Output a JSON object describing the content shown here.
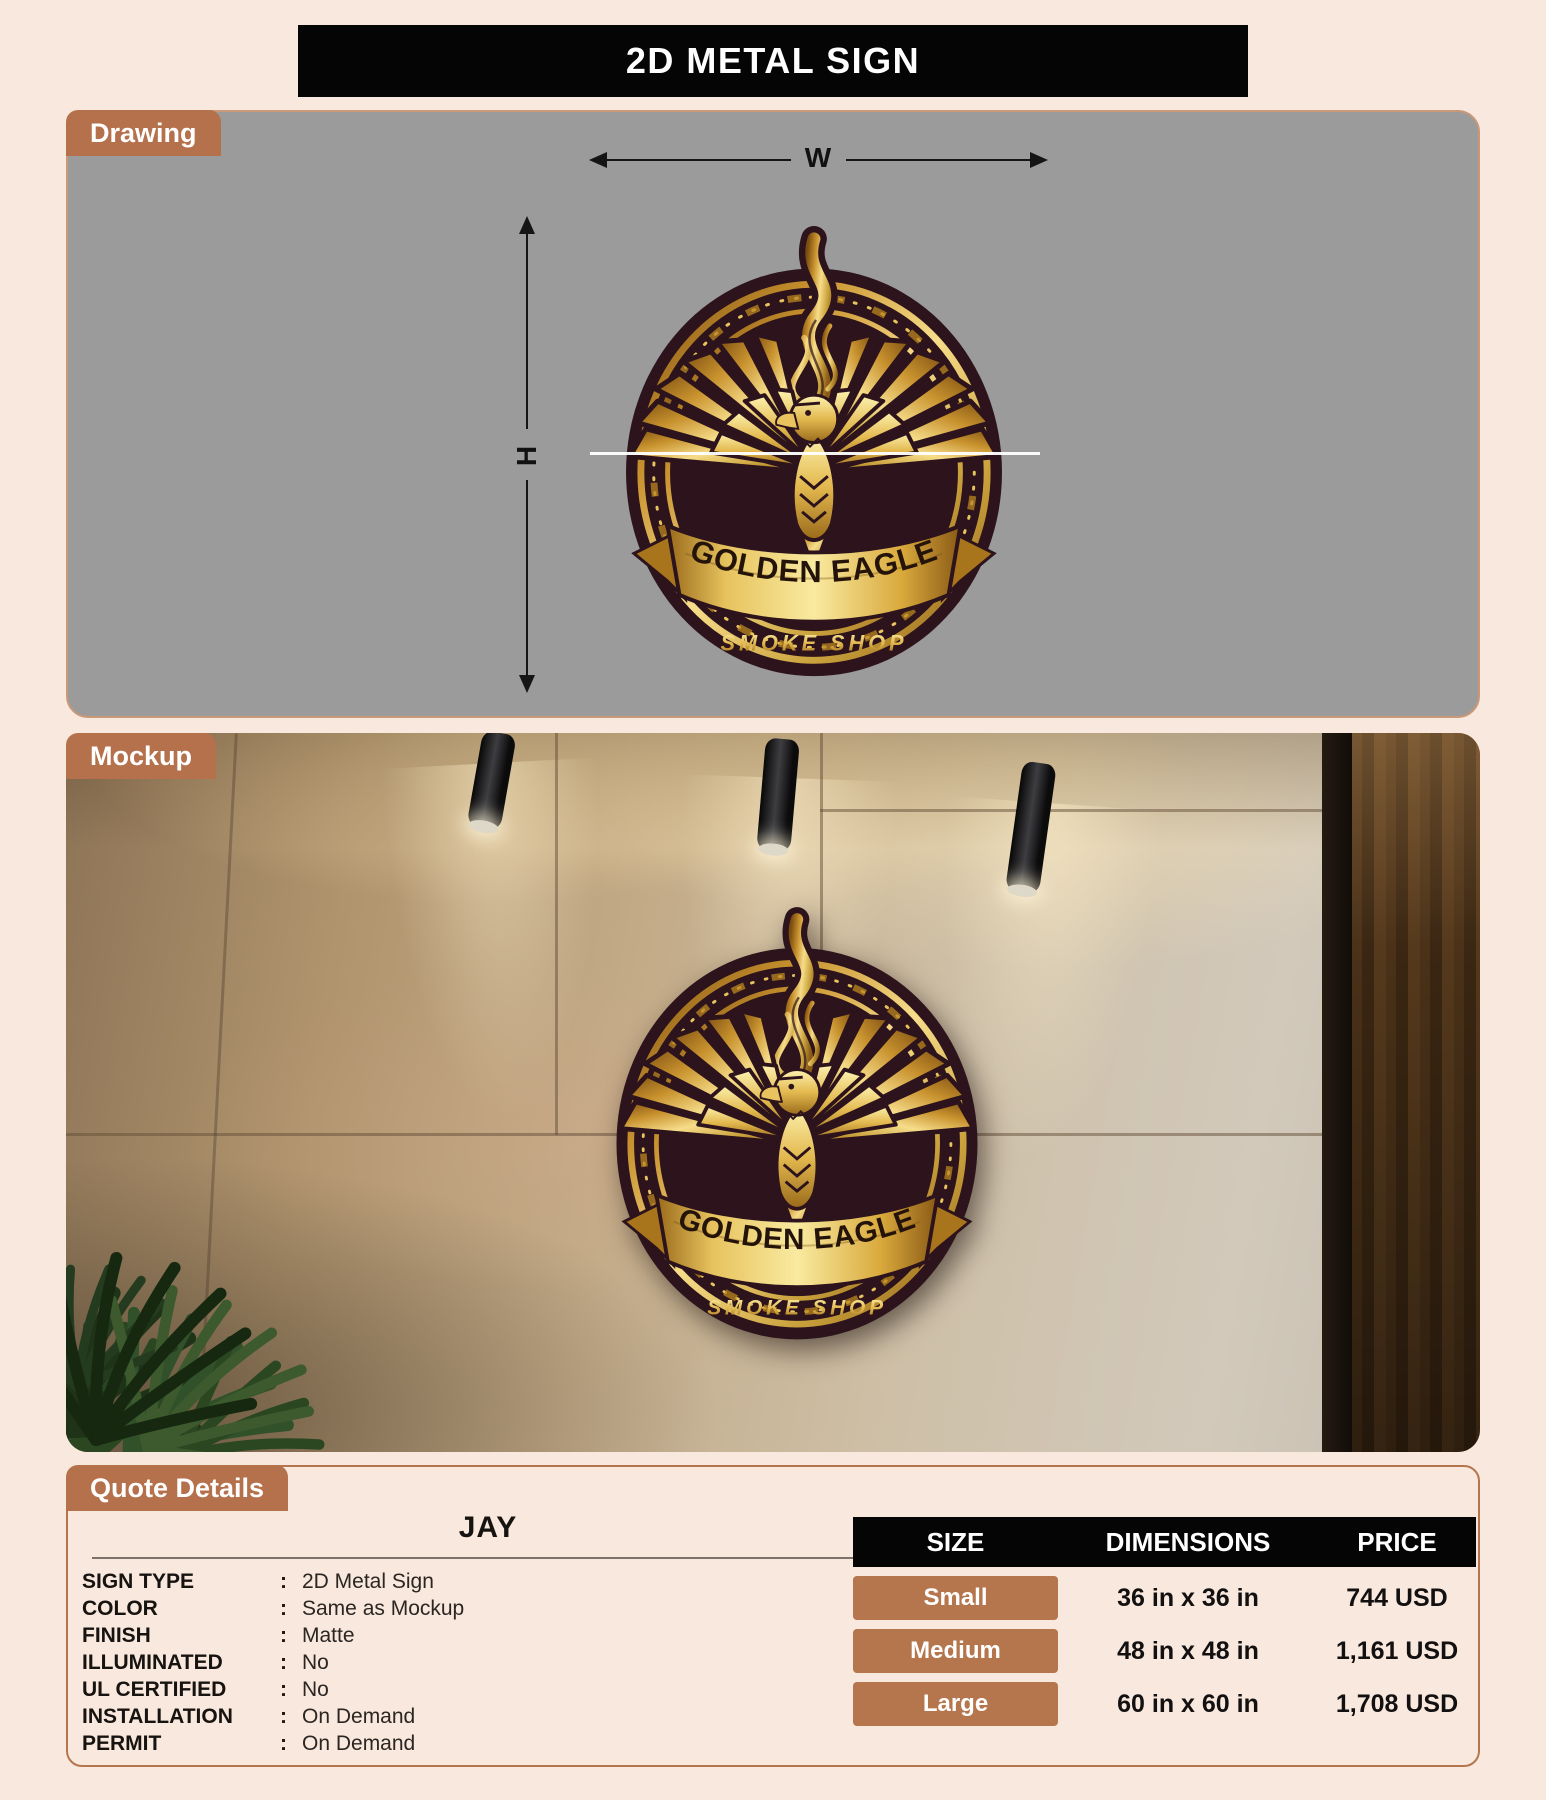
{
  "page": {
    "title": "2D METAL SIGN",
    "colors": {
      "background": "#f8e8dd",
      "accent_brown": "#b5714b",
      "panel_gray": "#9b9b9b",
      "header_black": "#050505",
      "badge_maroon": "#2c131c",
      "badge_gold": "#e3b94f"
    }
  },
  "drawing": {
    "tab_label": "Drawing",
    "width_label": "W",
    "height_label": "H"
  },
  "mockup": {
    "tab_label": "Mockup"
  },
  "badge": {
    "title": "GOLDEN EAGLE",
    "subtitle": "SMOKE SHOP"
  },
  "quote": {
    "tab_label": "Quote Details",
    "customer_name": "JAY",
    "separator": ":",
    "details": [
      {
        "label": "SIGN TYPE",
        "value": "2D Metal Sign"
      },
      {
        "label": "COLOR",
        "value": "Same as Mockup"
      },
      {
        "label": "FINISH",
        "value": "Matte"
      },
      {
        "label": "ILLUMINATED",
        "value": "No"
      },
      {
        "label": "UL CERTIFIED",
        "value": "No"
      },
      {
        "label": "INSTALLATION",
        "value": "On Demand"
      },
      {
        "label": "PERMIT",
        "value": "On Demand"
      }
    ],
    "pricing": {
      "headers": [
        "SIZE",
        "DIMENSIONS",
        "PRICE"
      ],
      "rows": [
        {
          "size": "Small",
          "dimensions": "36 in x 36 in",
          "price": "744 USD"
        },
        {
          "size": "Medium",
          "dimensions": "48 in x 48 in",
          "price": "1,161 USD"
        },
        {
          "size": "Large",
          "dimensions": "60 in x 60 in",
          "price": "1,708 USD"
        }
      ]
    }
  }
}
